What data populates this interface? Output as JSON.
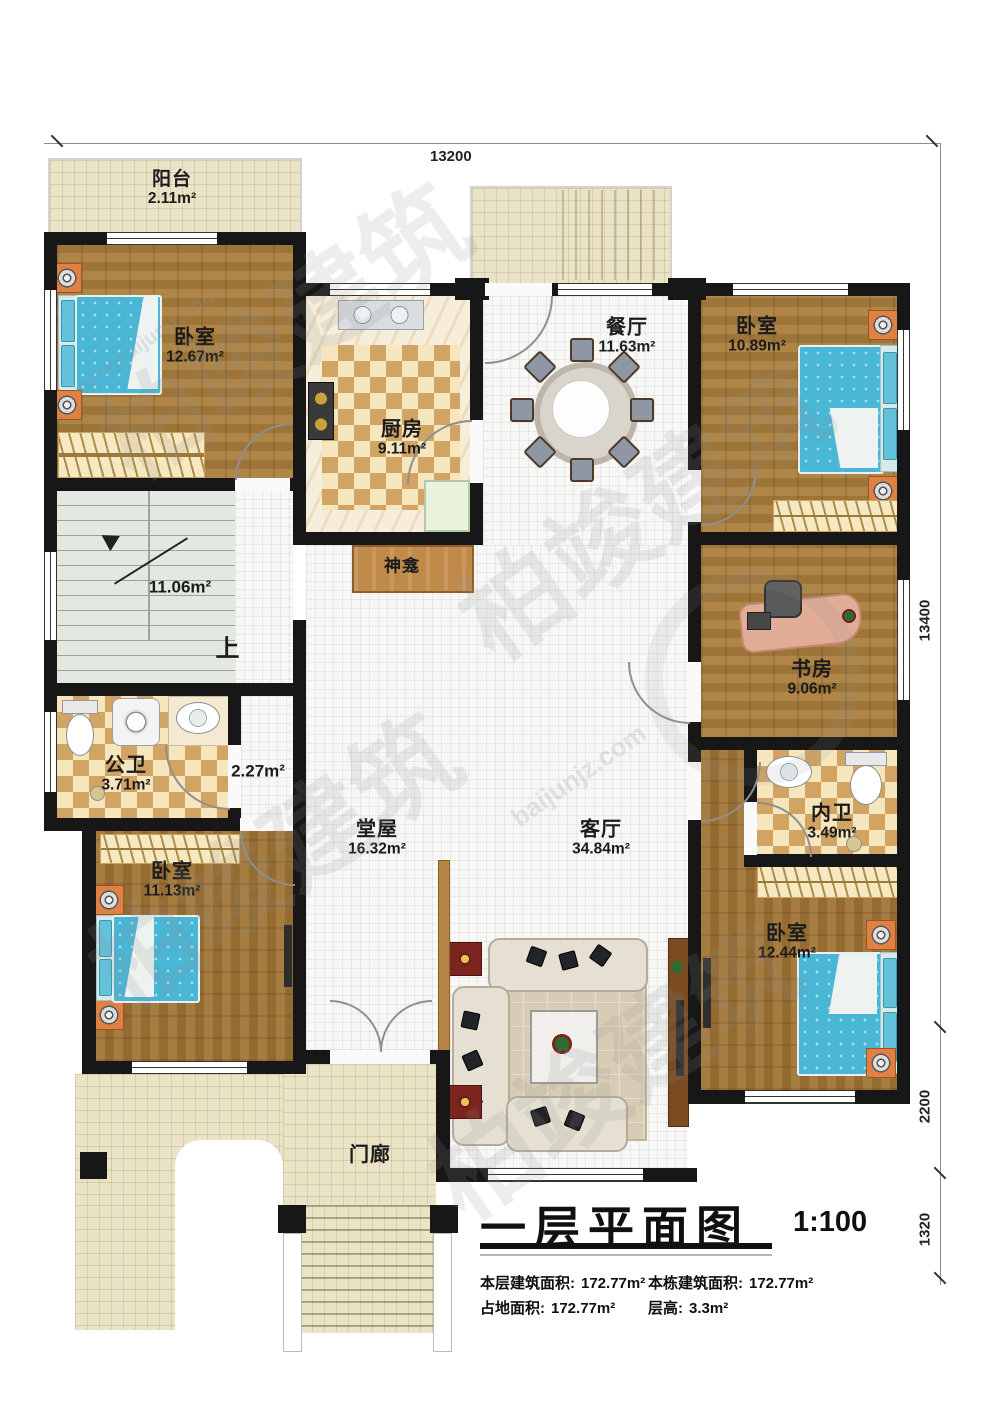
{
  "plan": {
    "title": "一层平面图",
    "scale": "1:100",
    "stats": [
      {
        "label": "本层建筑面积:",
        "value": "172.77m²"
      },
      {
        "label": "本栋建筑面积:",
        "value": "172.77m²"
      },
      {
        "label": "占地面积:",
        "value": "172.77m²"
      },
      {
        "label": "层高:",
        "value": "3.3m²"
      }
    ]
  },
  "dimensions": {
    "top": "13200",
    "right_total": "13400",
    "right_mid": "2200",
    "right_bottom": "1320"
  },
  "rooms": {
    "balcony": {
      "name": "阳台",
      "area": "2.11m²"
    },
    "bedroom_tl": {
      "name": "卧室",
      "area": "12.67m²"
    },
    "kitchen": {
      "name": "厨房",
      "area": "9.11m²"
    },
    "dining": {
      "name": "餐厅",
      "area": "11.63m²"
    },
    "bedroom_tr": {
      "name": "卧室",
      "area": "10.89m²"
    },
    "study": {
      "name": "书房",
      "area": "9.06m²"
    },
    "bath_inner": {
      "name": "内卫",
      "area": "3.49m²"
    },
    "bedroom_br": {
      "name": "卧室",
      "area": "12.44m²"
    },
    "living": {
      "name": "客厅",
      "area": "34.84m²"
    },
    "hall": {
      "name": "堂屋",
      "area": "16.32m²"
    },
    "bath_public": {
      "name": "公卫",
      "area": "3.71m²"
    },
    "bedroom_bl": {
      "name": "卧室",
      "area": "11.13m²"
    },
    "porch": {
      "name": "门廊"
    },
    "shrine": {
      "name": "神龛"
    },
    "stairs_up": {
      "name": "上"
    },
    "stair_area": {
      "area": "11.06m²"
    },
    "corridor": {
      "area": "2.27m²"
    }
  },
  "watermark": {
    "brand": "柏竣建筑",
    "domain": "baijunjz.com",
    "url": "www.baijunjz.com"
  }
}
